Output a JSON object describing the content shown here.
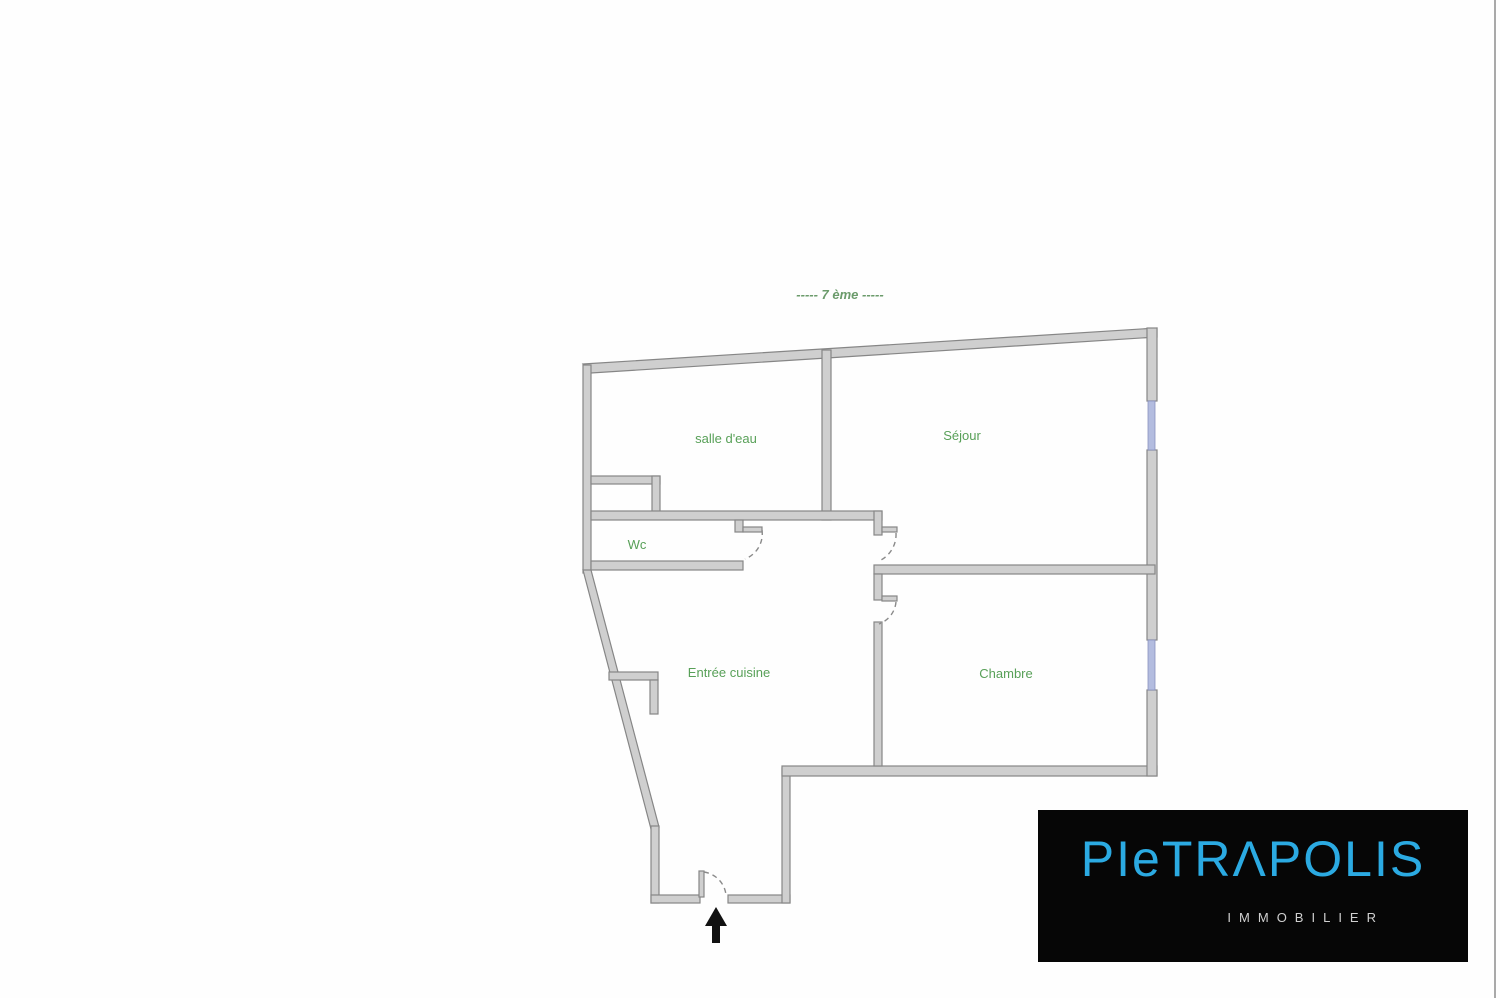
{
  "page": {
    "background_color": "#fefefe",
    "right_edge_line_color": "#a9a9a9"
  },
  "floor_plan": {
    "title": "-----  7 ème  -----",
    "title_color": "#6b9b6b",
    "label_color": "#58a058",
    "wall_fill_color": "#cfcfcf",
    "wall_stroke_color": "#868686",
    "window_color": "#b3bcdf",
    "rooms": [
      {
        "name": "salle d'eau"
      },
      {
        "name": "Séjour"
      },
      {
        "name": "Wc"
      },
      {
        "name": "Entrée cuisine"
      },
      {
        "name": "Chambre"
      }
    ],
    "features": {
      "windows": [
        "sejour-window",
        "chambre-window"
      ],
      "doors": [
        "wc-door",
        "sejour-door",
        "chambre-door",
        "entrance-door"
      ],
      "entrance_arrow_direction": "up"
    }
  },
  "logo": {
    "brand": "PIETRAPOLIS",
    "brand_display": "PIeTRΛPOLIS",
    "subtitle": "IMMOBILIER",
    "brand_color": "#2baae2",
    "subtitle_color": "#d0d0d0",
    "background_color": "#060606"
  }
}
